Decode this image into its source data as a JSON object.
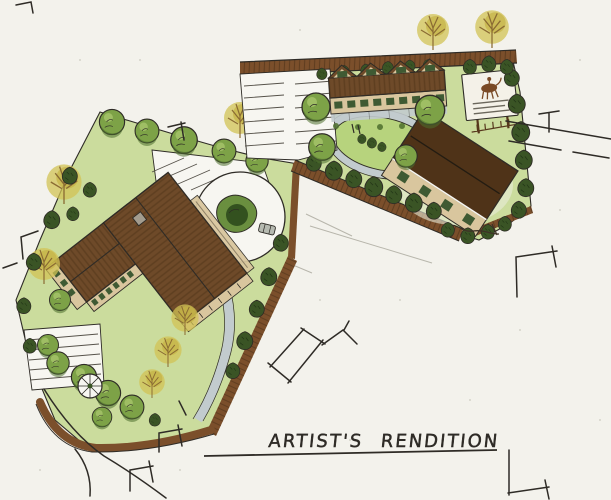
{
  "caption": {
    "text": "ARTIST'S RENDITION"
  },
  "palette": {
    "paper": "#f3f2ec",
    "pen": "#2e2b26",
    "pencil": "#a9a79c",
    "lawn": "#cbdc9d",
    "lawn-bright": "#b7d37d",
    "tree-green": "#7da247",
    "tree-light": "#a8c56b",
    "tree-dark": "#4e6f2e",
    "evergreen": "#3a5425",
    "tree-yellow": "#d2c355",
    "branch": "#8a6b33",
    "road-brown": "#7b4f2b",
    "road-dark": "#57381d",
    "roof-brown": "#6e4a29",
    "roof-dark": "#4f3318",
    "wall-tan": "#d9c69e",
    "window-green": "#3f5a33",
    "path-gray": "#c2cbce",
    "white-surface": "#f7f6f1",
    "sign-white": "#f4f1e8",
    "car-gray": "#b6bab1"
  },
  "features": {
    "icons": [
      "main-lodge-building-icon",
      "townhouse-row-icon",
      "barn-icon",
      "entrance-sign-icon",
      "roundabout-icon",
      "car-icon",
      "gazebo-icon",
      "oval-green-icon",
      "parking-stalls-icon",
      "deciduous-tree-icon",
      "evergreen-tree-icon",
      "autumn-tree-icon",
      "road-edge-icon",
      "neighbor-building-sketch-icon",
      "signature-scribble-icon"
    ]
  }
}
